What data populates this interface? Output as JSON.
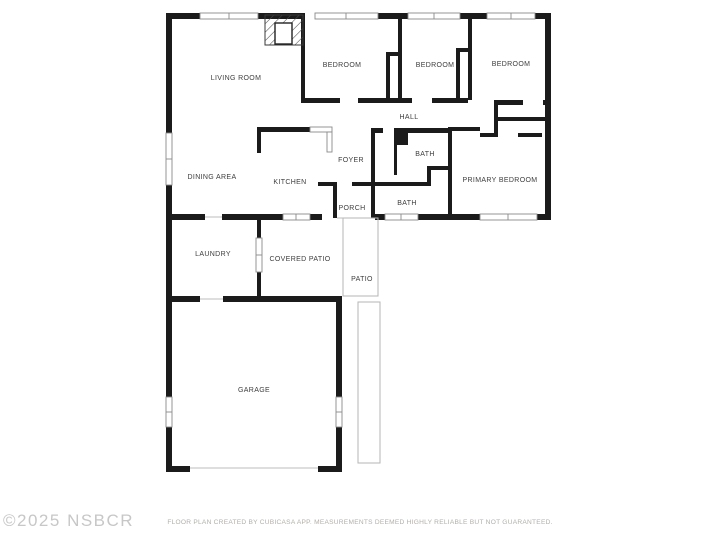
{
  "watermark": "©2025 NSBCR",
  "footer": "FLOOR PLAN CREATED BY CUBICASA APP. MEASUREMENTS DEEMED HIGHLY RELIABLE BUT NOT GUARANTEED.",
  "colors": {
    "wall": "#1b1b1b",
    "window_frame": "#8a8a8a",
    "door_line": "#bdbdbd",
    "patio_line": "#b5b5b5",
    "label": "#3d3d3d",
    "watermark": "#c7c7c7",
    "footer": "#b3afa9",
    "background": "#ffffff"
  },
  "rooms": [
    {
      "label": "LIVING ROOM"
    },
    {
      "label": "BEDROOM"
    },
    {
      "label": "BEDROOM"
    },
    {
      "label": "BEDROOM"
    },
    {
      "label": "HALL"
    },
    {
      "label": "FOYER"
    },
    {
      "label": "BATH"
    },
    {
      "label": "PRIMARY BEDROOM"
    },
    {
      "label": "BATH"
    },
    {
      "label": "PORCH"
    },
    {
      "label": "DINING AREA"
    },
    {
      "label": "KITCHEN"
    },
    {
      "label": "LAUNDRY"
    },
    {
      "label": "COVERED PATIO"
    },
    {
      "label": "PATIO"
    },
    {
      "label": "GARAGE"
    }
  ]
}
